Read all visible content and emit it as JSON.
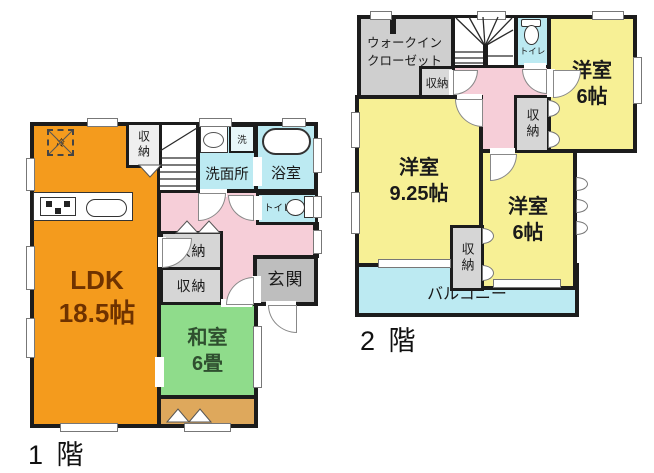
{
  "floor1": {
    "floor_label": "1 階",
    "ldk_name": "LDK",
    "ldk_size": "18.5帖",
    "washitsu_name": "和室",
    "washitsu_size": "6畳",
    "washroom": "洗面所",
    "bath": "浴室",
    "toilet": "トイレ",
    "entrance": "玄関",
    "storage_top": "収納",
    "storage_a": "収納",
    "storage_b": "収納",
    "washer": "洗",
    "fridge": "冷"
  },
  "floor2": {
    "floor_label": "2 階",
    "wic_line1": "ウォークイン",
    "wic_line2": "クローゼット",
    "storage_left": "収納",
    "storage_mid": "収納",
    "storage_bottom": "収納",
    "toilet": "トイレ",
    "room_a_name": "洋室",
    "room_a_size": "6帖",
    "room_b_name": "洋室",
    "room_b_size": "9.25帖",
    "room_c_name": "洋室",
    "room_c_size": "6帖",
    "balcony": "バルコニー"
  },
  "colors": {
    "orange": "#F49B1D",
    "green": "#8FDC8B",
    "tan": "#DEA85C",
    "pink": "#F6CED8",
    "cyan": "#BCEAF2",
    "yellow": "#F7F095",
    "storage_gray": "#D6D6D6",
    "storage_light": "#EFEFEF",
    "entrance_gray": "#BEBEBE",
    "wall": "#1C1C1C",
    "ldk_text": "#6E3200",
    "washitsu_text": "#2F4F2F",
    "text_dark": "#1A1A1A"
  }
}
